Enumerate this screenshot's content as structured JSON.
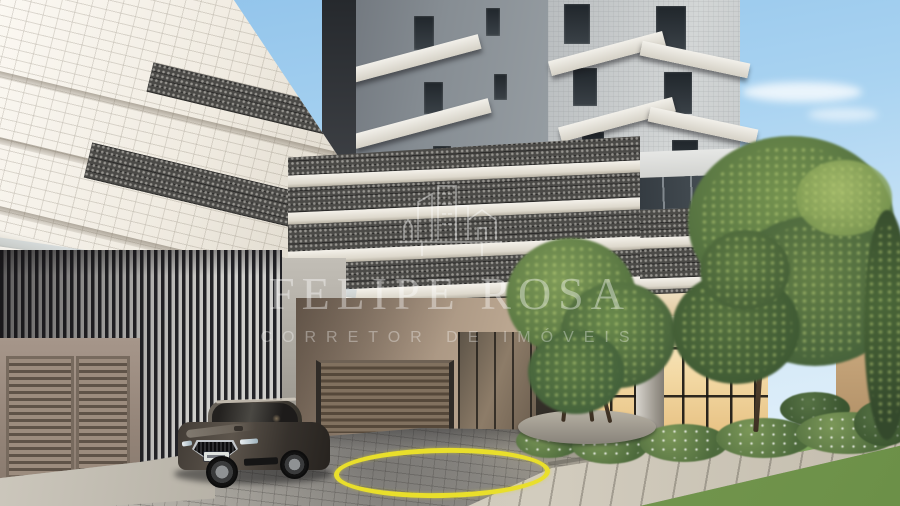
{
  "watermark": {
    "logo": "city-skyline-icon",
    "title": "FELIPE ROSA",
    "subtitle": "CORRETOR DE IMÓVEIS",
    "text_color": "#ffffff"
  },
  "scene": {
    "kind": "architectural exterior render of residential building entrance",
    "objects": {
      "car": "dark luxury sedan",
      "highlight_circle": "yellow ellipse marked on driveway pavers",
      "lobby": "warm-lit glass entrance lobby",
      "garage": "louvered garage doors and slatted gate",
      "landscape": "trees, shrubs with white flowers, lawn"
    },
    "colors": {
      "sky_top": "#8fc2ea",
      "sky_horizon": "#e9f4fb",
      "facade_white": "#efece4",
      "perforated_panel": "#4b4a47",
      "tower_gray": "#868d93",
      "louver_dark": "#232327",
      "garage_door": "#8b7a6c",
      "wall_beige": "#a5927f",
      "lobby_glow": "#f3d9a4",
      "pavers": "#9b9892",
      "sidewalk": "#cdc7ba",
      "grass": "#7da45c",
      "foliage": "#5d7b45",
      "car_body": "#423c36",
      "highlight_yellow": "#e9df2b"
    }
  }
}
